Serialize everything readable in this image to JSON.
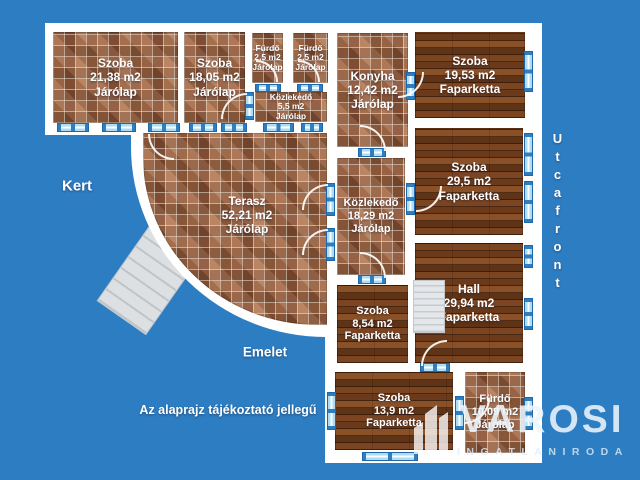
{
  "plan": {
    "rooms": {
      "szoba2138": {
        "name": "Szoba",
        "area": "21,38 m2",
        "floor": "Járólap"
      },
      "szoba1805": {
        "name": "Szoba",
        "area": "18,05 m2",
        "floor": "Járólap"
      },
      "furdo_a": {
        "name": "Fürdő",
        "area": "2,5 m2",
        "floor": "Járólap"
      },
      "furdo_b": {
        "name": "Fürdő",
        "area": "2,5 m2",
        "floor": "Járólap"
      },
      "kozlekedo55": {
        "name": "Közlekedő",
        "area": "5,5 m2",
        "floor": "Járólap"
      },
      "konyha": {
        "name": "Konyha",
        "area": "12,42 m2",
        "floor": "Járólap"
      },
      "terasz": {
        "name": "Terasz",
        "area": "52,21 m2",
        "floor": "Járólap"
      },
      "szoba1953": {
        "name": "Szoba",
        "area": "19,53 m2",
        "floor": "Faparketta"
      },
      "szoba295": {
        "name": "Szoba",
        "area": "29,5 m2",
        "floor": "Faparketta"
      },
      "kozlekedo1829": {
        "name": "Közlekedő",
        "area": "18,29 m2",
        "floor": "Járólap"
      },
      "hall": {
        "name": "Hall",
        "area": "29,94 m2",
        "floor": "Faparketta"
      },
      "szoba854": {
        "name": "Szoba",
        "area": "8,54 m2",
        "floor": "Faparketta"
      },
      "szoba139": {
        "name": "Szoba",
        "area": "13,9 m2",
        "floor": "Faparketta"
      },
      "furdo1009": {
        "name": "Fürdő",
        "area": "10,09 m2",
        "floor": "Járólap"
      }
    },
    "labels": {
      "garden": "Kert",
      "level": "Emelet",
      "street_front": "Utcafront",
      "disclaimer": "Az alaprajz tájékoztató jellegű"
    }
  },
  "logo": {
    "brand": "VAROSI",
    "subtitle": "INGATLANIRODA"
  },
  "colors": {
    "background": "#2D7DC2",
    "wall": "#FFFFFF",
    "window_fill": "#AEDCF2",
    "window_frame": "#1E67AC",
    "tile_base": "#A86F4E",
    "wood_base": "#6E3D1E",
    "stairs": "#DDE0E3"
  }
}
